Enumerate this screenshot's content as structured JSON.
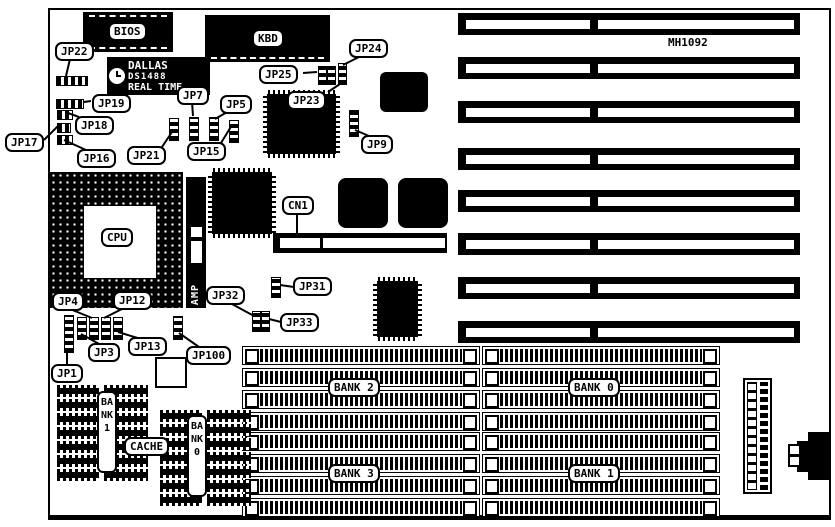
{
  "board": {
    "model": "MH1092",
    "isa_slot_count": 8
  },
  "chips": {
    "bios": "BIOS",
    "kbd": "KBD",
    "cpu": "CPU",
    "amp": "AMP",
    "rtc": [
      "DALLAS",
      "DS1488",
      "REAL TIME"
    ]
  },
  "connectors": {
    "cn1": "CN1"
  },
  "labels": {
    "jp1": "JP1",
    "jp3": "JP3",
    "jp4": "JP4",
    "jp5": "JP5",
    "jp7": "JP7",
    "jp9": "JP9",
    "jp12": "JP12",
    "jp13": "JP13",
    "jp15": "JP15",
    "jp16": "JP16",
    "jp17": "JP17",
    "jp18": "JP18",
    "jp19": "JP19",
    "jp21": "JP21",
    "jp22": "JP22",
    "jp23": "JP23",
    "jp24": "JP24",
    "jp25": "JP25",
    "jp31": "JP31",
    "jp32": "JP32",
    "jp33": "JP33",
    "jp100": "JP100"
  },
  "memory": {
    "banks": [
      "BANK 2",
      "BANK 3",
      "BANK 0",
      "BANK 1"
    ],
    "slots_per_bank": 4
  },
  "cache": {
    "label": "CACHE",
    "bank_left": "BANK1",
    "bank_right": "BANK0"
  }
}
